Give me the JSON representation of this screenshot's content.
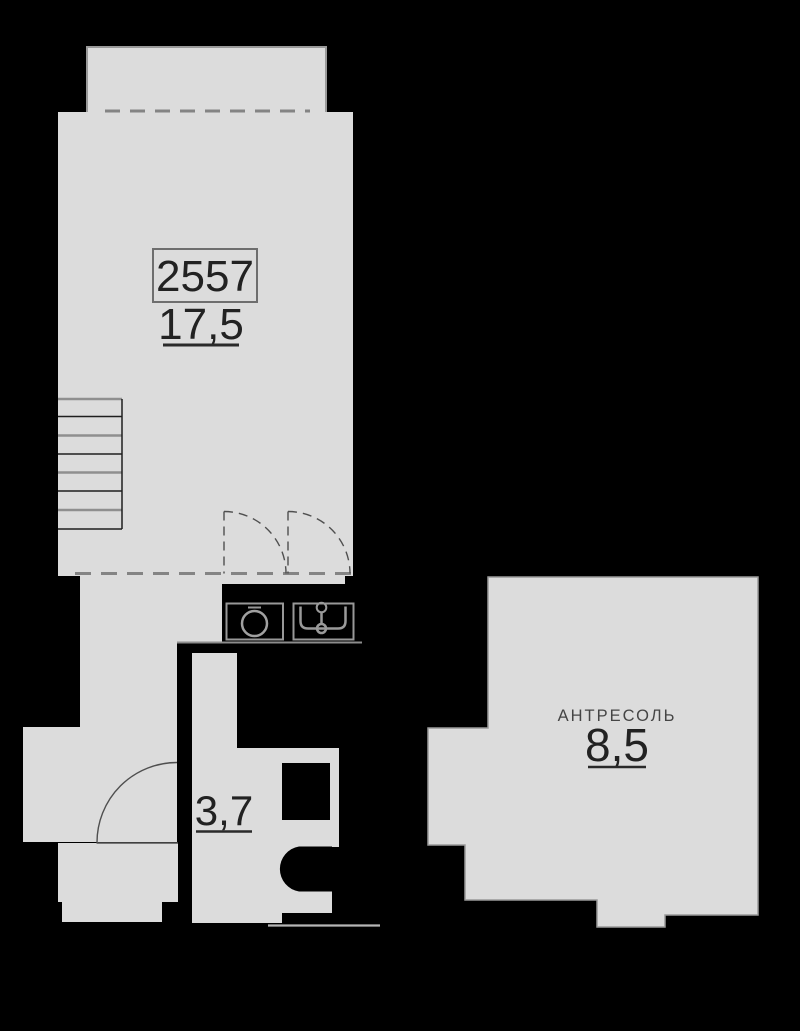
{
  "plan": {
    "unit_number": "2557",
    "main_room": {
      "area": "17,5"
    },
    "hall_room": {
      "area": "3,7"
    },
    "mezzanine": {
      "name": "АНТРЕСОЛЬ",
      "area": "8,5"
    },
    "colors": {
      "background": "#000000",
      "floor_fill": "#dcdcdc",
      "wall_outline": "#9a9a9a",
      "dashed_wall": "#848484",
      "door_arc": "#4f4f4f",
      "fixture_outline": "#989898",
      "number_text": "#222222",
      "label_text": "#454545",
      "rail_line": "#b5b5b5"
    },
    "fixtures": [
      "stairs",
      "door-swing",
      "washing-machine",
      "kitchen-sink",
      "toilet"
    ]
  }
}
